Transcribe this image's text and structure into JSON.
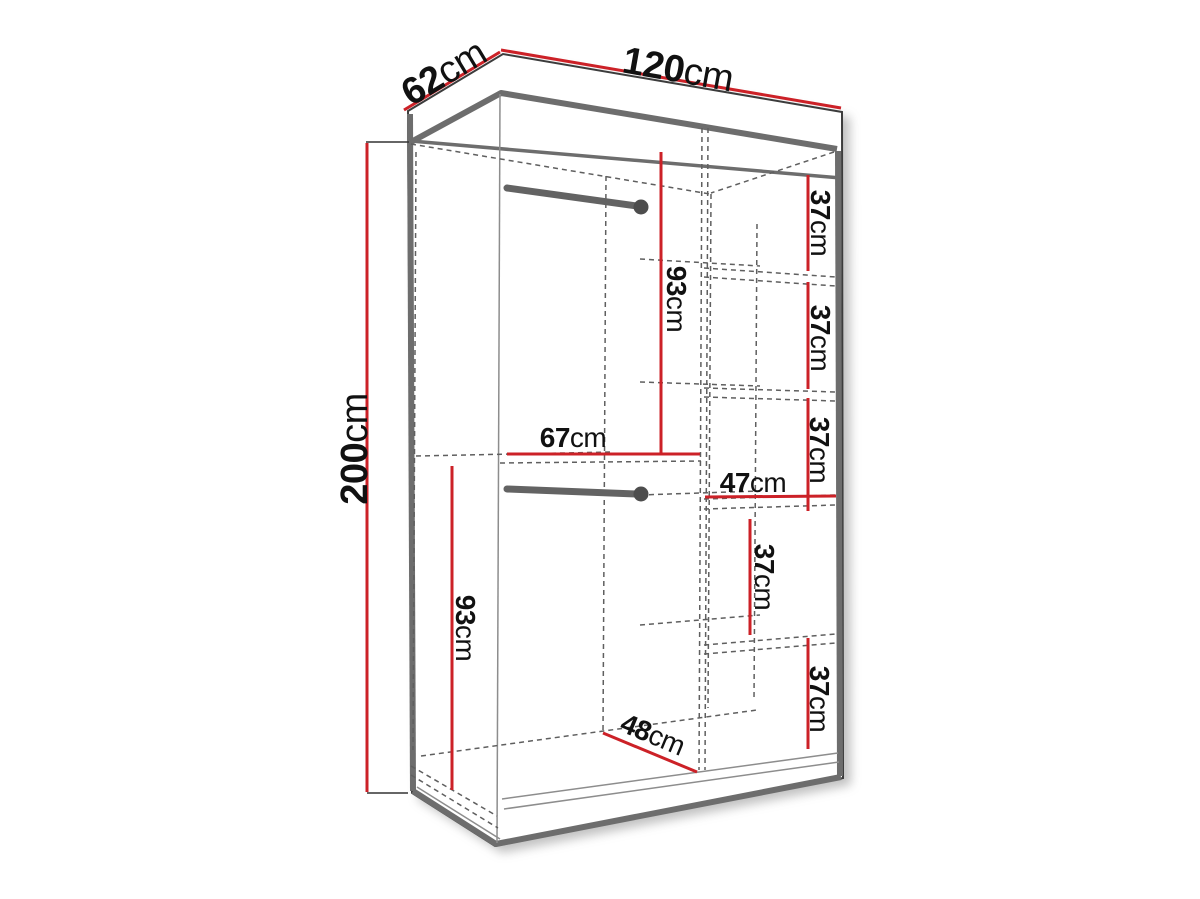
{
  "colors": {
    "dimension_line": "#cc2127",
    "edge": "#6d6d6d",
    "outline": "#3c3c3c",
    "dashed": "#5f5f5f",
    "text": "#111111",
    "background": "#ffffff",
    "rod": "#636363",
    "knob": "#4d4d4d"
  },
  "dims": {
    "depth": {
      "num": "62",
      "unit": "cm"
    },
    "width": {
      "num": "120",
      "unit": "cm"
    },
    "height": {
      "num": "200",
      "unit": "cm"
    },
    "upper_hang": {
      "num": "93",
      "unit": "cm"
    },
    "left_width": {
      "num": "67",
      "unit": "cm"
    },
    "shelf_col_width": {
      "num": "47",
      "unit": "cm"
    },
    "shelf_1": {
      "num": "37",
      "unit": "cm"
    },
    "shelf_2": {
      "num": "37",
      "unit": "cm"
    },
    "shelf_3": {
      "num": "37",
      "unit": "cm"
    },
    "shelf_4": {
      "num": "37",
      "unit": "cm"
    },
    "shelf_5": {
      "num": "37",
      "unit": "cm"
    },
    "lower_hang": {
      "num": "93",
      "unit": "cm"
    },
    "floor_depth": {
      "num": "48",
      "unit": "cm"
    }
  }
}
